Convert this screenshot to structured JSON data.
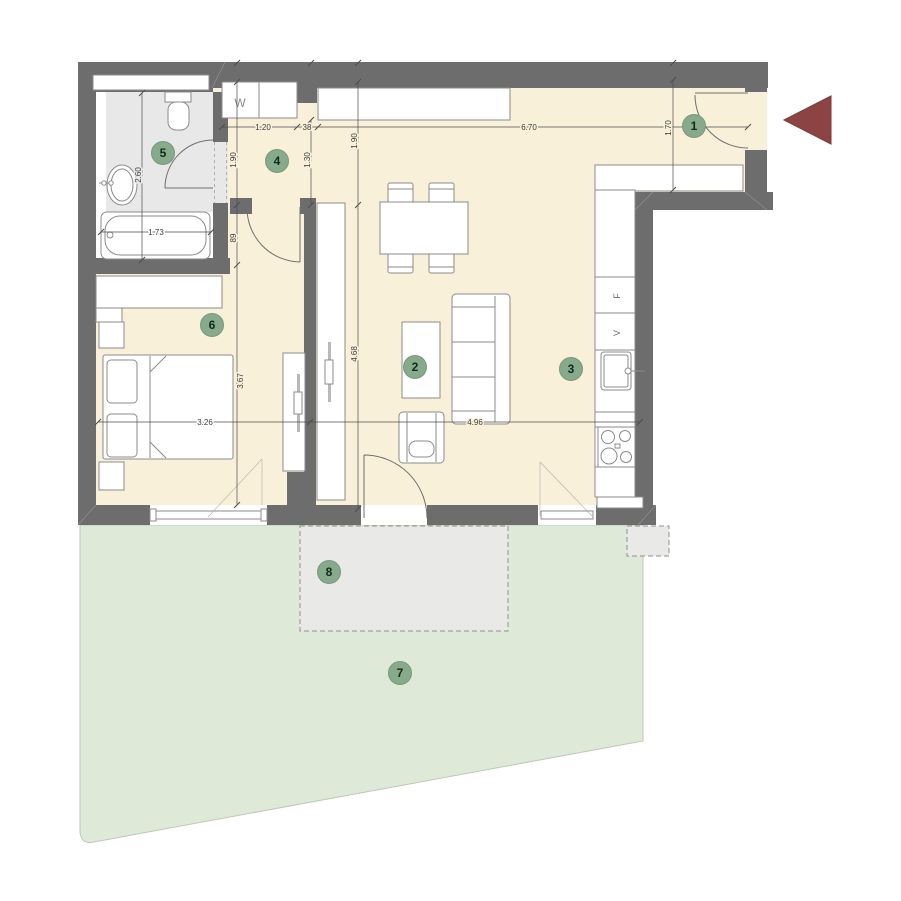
{
  "meta": {
    "type": "apartment floor plan"
  },
  "colors": {
    "wall": "#6d6d6d",
    "floor": "#f9f0da",
    "bathroom_floor": "#e8e8e8",
    "terrace": "#e9e9e7",
    "garden": "#dfe9d8",
    "badge": "#86aa8b",
    "entry_arrow": "#8c4343"
  },
  "rooms": [
    {
      "number": "1"
    },
    {
      "number": "2"
    },
    {
      "number": "3"
    },
    {
      "number": "4"
    },
    {
      "number": "5"
    },
    {
      "number": "6"
    },
    {
      "number": "7"
    },
    {
      "number": "8"
    }
  ],
  "appliances": {
    "washer": "W",
    "fridge": "F",
    "ventilation": "V"
  },
  "dims": {
    "closet_width": "1.20",
    "niche_width": "38",
    "living_top_width": "6.70",
    "hall_left_depth": "1.90",
    "hall_mid_depth": "1.30",
    "hall_right_depth": "1.90",
    "entry_depth": "1.70",
    "bath_depth": "2.60",
    "tub_length": "1.73",
    "door_width": "89",
    "bedroom_width": "3.26",
    "bedroom_depth": "3.67",
    "living_width": "4.96",
    "living_depth": "4.68"
  }
}
